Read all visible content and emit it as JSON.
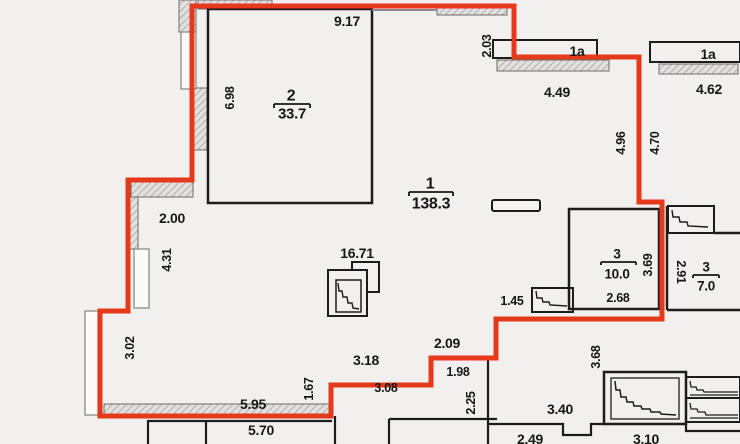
{
  "floor_plan": {
    "rooms": [
      {
        "number": "2",
        "area": "33.7"
      },
      {
        "number": "1",
        "area": "138.3"
      },
      {
        "number": "3",
        "area": "10.0"
      },
      {
        "number": "3",
        "area": "7.0"
      }
    ],
    "balconies": [
      {
        "label": "1a",
        "width": "4.49"
      },
      {
        "label": "1a",
        "width": "4.62"
      }
    ],
    "dims": {
      "d9_17": "9.17",
      "d2_03": "2.03",
      "d6_98": "6.98",
      "d4_96": "4.96",
      "d4_70": "4.70",
      "d2_00": "2.00",
      "d4_31": "4.31",
      "d16_71": "16.71",
      "d3_02": "3.02",
      "d1_45": "1.45",
      "d3_69": "3.69",
      "d2_68": "2.68",
      "d2_91": "2.91",
      "d5_95": "5.95",
      "d5_70": "5.70",
      "d1_67": "1.67",
      "d3_18": "3.18",
      "d2_09": "2.09",
      "d1_98": "1.98",
      "d3_08": "3.08",
      "d2_25": "2.25",
      "d3_40": "3.40",
      "d3_68": "3.68",
      "d2_49": "2.49",
      "d3_10": "3.10"
    },
    "colors": {
      "boundary_red": "#e6391b",
      "line_black": "#1c1c1c",
      "background": "#f1f0ee",
      "wall_hatch": "#b9b8b5"
    }
  }
}
